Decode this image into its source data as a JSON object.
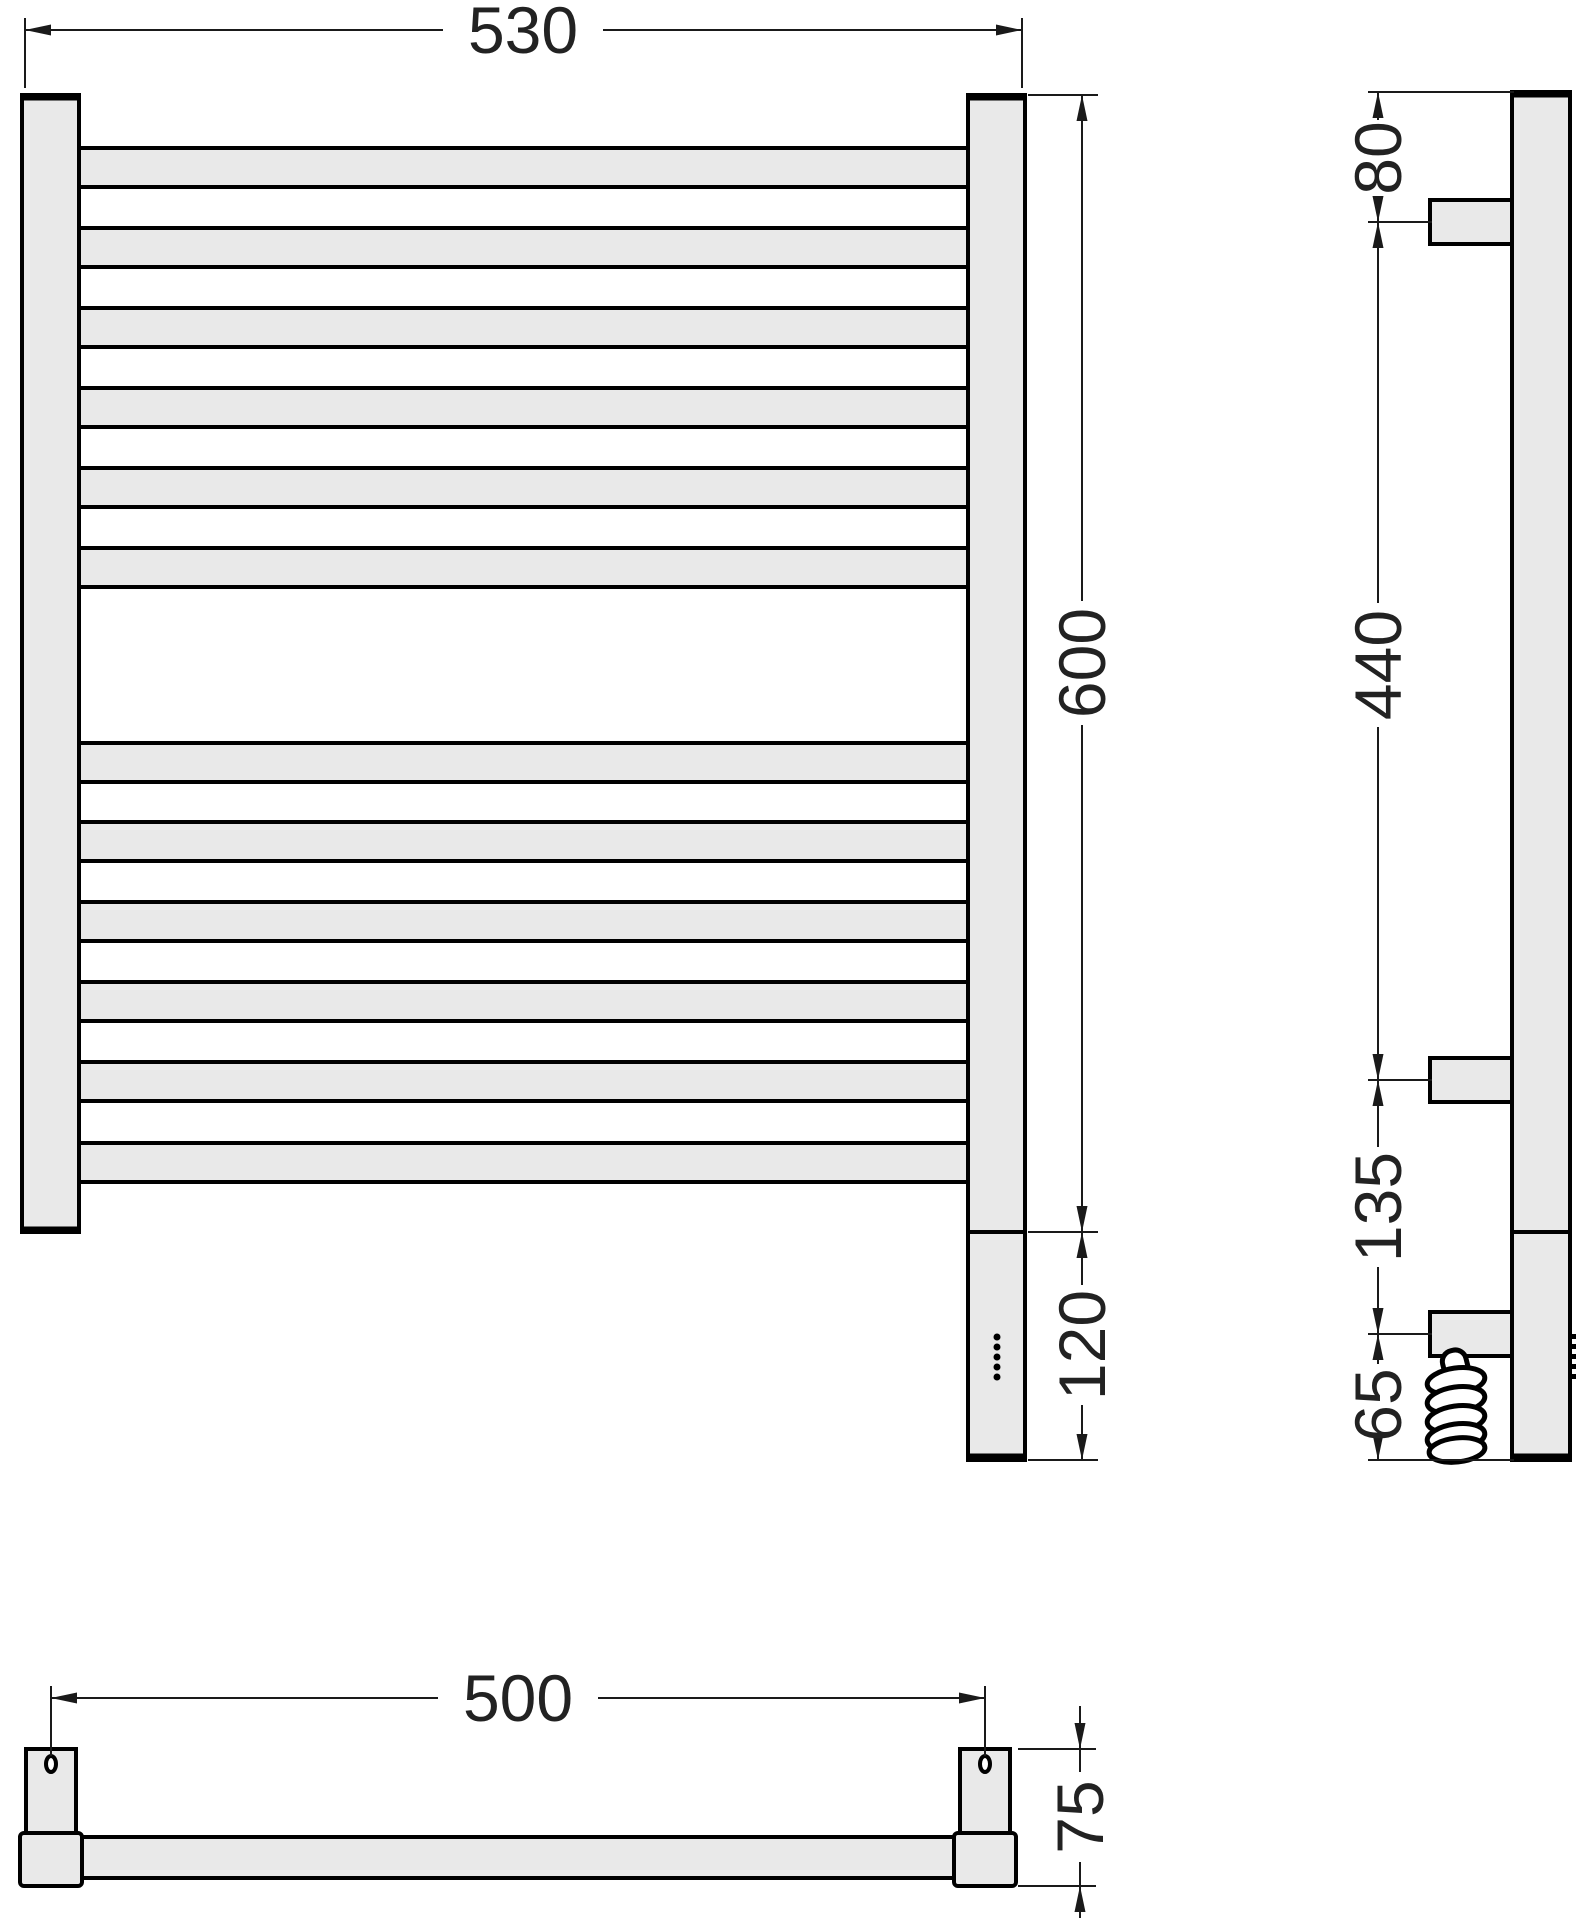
{
  "drawing": {
    "type": "towel-rail-technical-drawing",
    "dims": {
      "front_width": "530",
      "front_height": "600",
      "heater_section_height": "120",
      "side_top_to_bracket": "80",
      "side_bracket_spacing": "440",
      "side_bracket_to_lower": "135",
      "side_lower_to_bottom": "65",
      "mount_hole_spacing": "500",
      "wall_depth": "75"
    },
    "structure": {
      "rung_count": 12,
      "rung_top_group": 6,
      "rung_bottom_group": 6,
      "indicator_dot_count": 5,
      "wall_bracket_count": 3,
      "cable_coil_turns": 5
    },
    "colors": {
      "surface_fill": "#e9e9e9",
      "outline": "#000000",
      "dimension_line": "#1a1a1a",
      "dimension_text": "#222222",
      "background": "#ffffff"
    }
  }
}
